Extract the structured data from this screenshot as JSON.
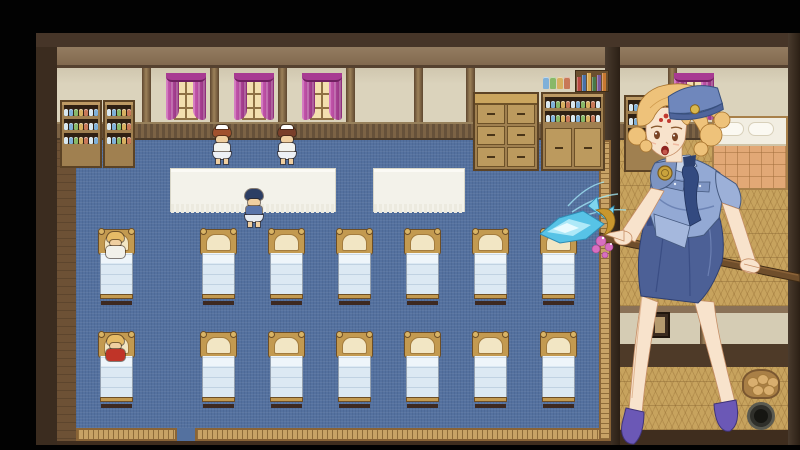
{
  "meta": {
    "app": "rpg-game",
    "scene": "dormitory-infirmary-room",
    "visible_text": "none"
  },
  "palette": {
    "letterbox": "#020202",
    "outer_wall": "#3b2c1f",
    "wall_panel": "#dbd3bc",
    "wainscot": "#7c6345",
    "carpet": "#54719f",
    "carpet_border": "#c8a266",
    "curtain": "#b2409a",
    "window_glow": "#f3dfae",
    "bed_frame": "#c39a50",
    "bed_sheet": "#dce9f3",
    "tatami": "#c7a35e",
    "skin": "#f0cfa0",
    "jar_colors": [
      "#d8e8f0",
      "#7fb0d8",
      "#88b868",
      "#d8b060",
      "#c87858"
    ],
    "book_colors": [
      "#b84840",
      "#4870a8",
      "#d8a850",
      "#487848",
      "#7858a0",
      "#c87830"
    ]
  },
  "room": {
    "windows": [
      {
        "x": 166
      },
      {
        "x": 234
      },
      {
        "x": 302
      }
    ],
    "right_window": {
      "x": 674
    },
    "wall_dividers": [
      142,
      210,
      278,
      346,
      414,
      466
    ],
    "tables": [
      {
        "x": 170,
        "w": 166
      },
      {
        "x": 373,
        "w": 92
      }
    ],
    "beds": {
      "cols": [
        98,
        200,
        268,
        336,
        404,
        472,
        540
      ],
      "rows": [
        229,
        332
      ],
      "count": 14
    },
    "exit_gap": {
      "x": 177,
      "w": 18
    },
    "left_cabinets": [
      {
        "x": 60,
        "w": 42,
        "shelves": 3
      },
      {
        "x": 103,
        "w": 32,
        "shelves": 3
      }
    ],
    "right_shelf_unit": {
      "x": 541,
      "w": 64,
      "shelves": 2
    },
    "right_room_shelf": {
      "x": 624,
      "w": 44,
      "shelves": 3
    }
  },
  "characters": [
    {
      "id": "nurse-1",
      "x": 211,
      "y": 126,
      "hair": "#a1512e",
      "top": "#f3f3ee",
      "skirt": "#eef1f6",
      "cap": true
    },
    {
      "id": "nurse-2",
      "x": 276,
      "y": 126,
      "hair": "#7a3f2a",
      "top": "#f3f3ee",
      "skirt": "#eef1f6",
      "cap": true
    },
    {
      "id": "officer",
      "x": 243,
      "y": 189,
      "hair": "#2c3e64",
      "top": "#5a74aa",
      "skirt": "#e8ecf2",
      "cap": false
    },
    {
      "id": "patient-in-bed-white",
      "x": 102,
      "y": 232,
      "hair": "#e6bb66",
      "top": "#f2f1ea",
      "inbed": true
    },
    {
      "id": "patient-in-bed-red",
      "x": 102,
      "y": 335,
      "hair": "#e6bb66",
      "top": "#c03428",
      "inbed": true
    }
  ],
  "right_room": {
    "bed_blanket": "#e2a876",
    "basket": {
      "x": 742,
      "y": 369
    },
    "pot": {
      "x": 747,
      "y": 402
    },
    "picture": {
      "x": 650,
      "y": 312
    }
  },
  "portrait": {
    "id": "policewoman-portrait",
    "hair": "#eec27a",
    "skin": "#f8e3cc",
    "uniform": "#93a9d4",
    "tie_skirt": "#44588f",
    "heels": "#6b58b6",
    "weapon": "ice-spear",
    "ice": "#7fd6ee",
    "shaft": "#6f4e2b"
  }
}
